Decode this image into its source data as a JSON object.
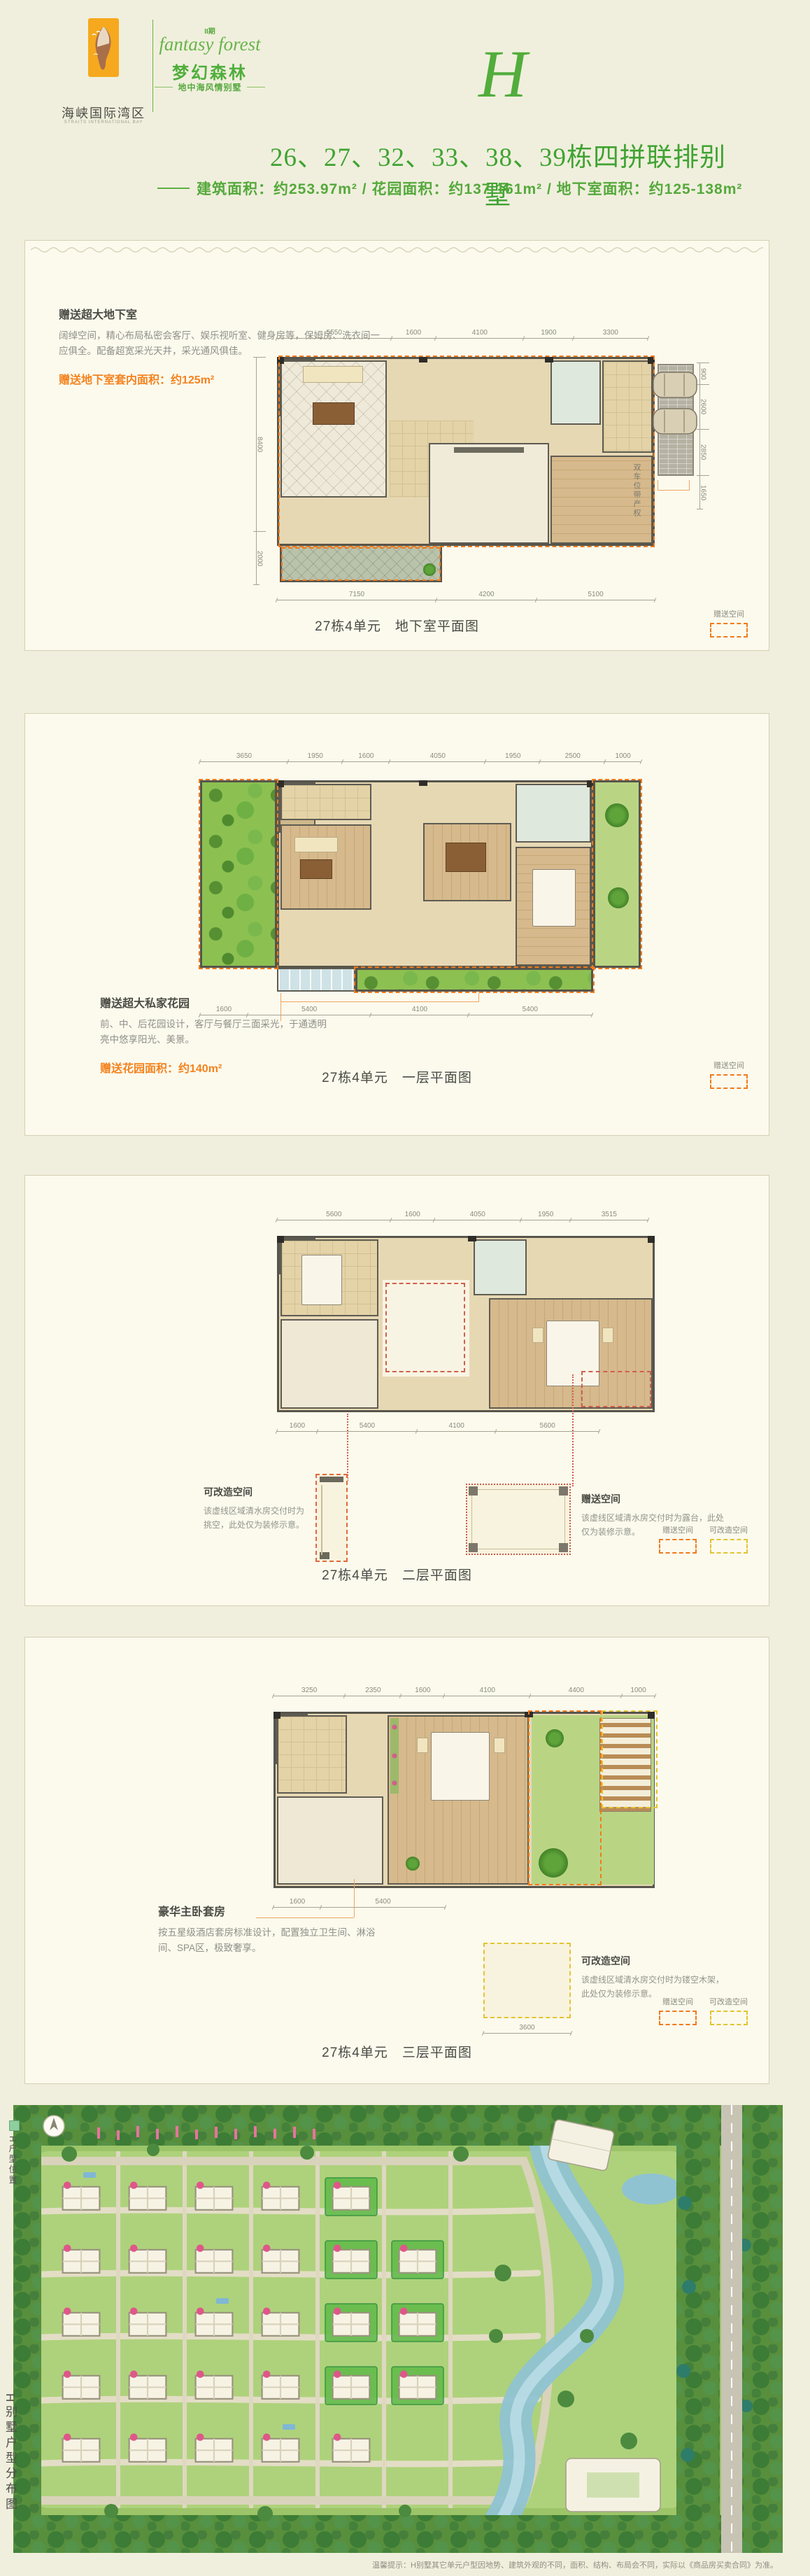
{
  "header": {
    "logo_cn": "海峡国际湾区",
    "logo_en": "STRAITS INTERNATIONAL BAY",
    "phase": "II期",
    "script_name": "fantasy forest",
    "project_cn": "梦幻森林",
    "tagline": "地中海风情别墅",
    "unit_letter": "H"
  },
  "title": "26、27、32、33、38、39栋四拼联排别墅",
  "subtitle": "建筑面积：约253.97m² / 花园面积：约137-161m² / 地下室面积：约125-138m²",
  "sections": [
    {
      "caption": "27栋4单元　地下室平面图",
      "note_title": "赠送超大地下室",
      "note_body": "阔绰空间，精心布局私密会客厅、娱乐视听室、健身房等，保姆房、洗衣间一应俱全。配备超宽采光天井，采光通风俱佳。",
      "highlight": "赠送地下室套内面积：约125m²",
      "side_note": "双车位带产权",
      "dims_top": [
        "5550",
        "1600",
        "4100",
        "1900",
        "3300"
      ],
      "dims_bottom": [
        "7150",
        "4200",
        "5100"
      ],
      "dims_left": [
        "8400",
        "2000"
      ],
      "dims_right": [
        "900",
        "2600",
        "2850",
        "1650"
      ],
      "legend": [
        {
          "label": "赠送空间",
          "color": "#f07b1d"
        }
      ]
    },
    {
      "caption": "27栋4单元　一层平面图",
      "note_title": "赠送超大私家花园",
      "note_body": "前、中、后花园设计，客厅与餐厅三面采光，于通透明亮中悠享阳光、美景。",
      "highlight": "赠送花园面积：约140m²",
      "dims_top": [
        "3650",
        "1950",
        "1600",
        "4050",
        "1950",
        "2500",
        "1000"
      ],
      "dims_bottom": [
        "1600",
        "5400",
        "4100",
        "5400"
      ],
      "legend": [
        {
          "label": "赠送空间",
          "color": "#f07b1d"
        }
      ]
    },
    {
      "caption": "27栋4单元　二层平面图",
      "annotations": [
        {
          "title": "可改造空间",
          "body": "该虚线区域清水房交付时为挑空，此处仅为装修示意。"
        },
        {
          "title": "赠送空间",
          "body": "该虚线区域清水房交付时为露台，此处仅为装修示意。"
        }
      ],
      "dims_top": [
        "5600",
        "1600",
        "4050",
        "1950",
        "3515"
      ],
      "dims_bottom": [
        "1600",
        "5400",
        "4100",
        "5600"
      ],
      "legend": [
        {
          "label": "赠送空间",
          "color": "#f07b1d"
        },
        {
          "label": "可改造空间",
          "color": "#e3c430"
        }
      ]
    },
    {
      "caption": "27栋4单元　三层平面图",
      "note_title": "豪华主卧套房",
      "note_body": "按五星级酒店套房标准设计，配置独立卫生间、淋浴间、SPA区，极致奢享。",
      "annotations": [
        {
          "title": "可改造空间",
          "body": "该虚线区域清水房交付时为镂空木架，此处仅为装修示意。"
        }
      ],
      "dims_top": [
        "3250",
        "2350",
        "1600",
        "4100",
        "4400",
        "1000"
      ],
      "dims_bottom": [
        "1600",
        "5400"
      ],
      "inset_dim": "3600",
      "legend": [
        {
          "label": "赠送空间",
          "color": "#f07b1d"
        },
        {
          "label": "可改造空间",
          "color": "#e3c430"
        }
      ]
    }
  ],
  "site_map": {
    "marker_label": "H户型位置",
    "map_title": "H别墅户型分布图",
    "disclaimer": "温馨提示：H别墅其它单元户型因地势、建筑外观的不同，面积、结构、布局会不同，实际以《商品房买卖合同》为准。"
  },
  "colors": {
    "brand_green": "#4fae3b",
    "accent_orange": "#f5821e",
    "gift_dash": "#f07b1d",
    "convertible_dash": "#e3c430",
    "text_dark": "#4b4b45",
    "text_gray": "#90908a"
  }
}
